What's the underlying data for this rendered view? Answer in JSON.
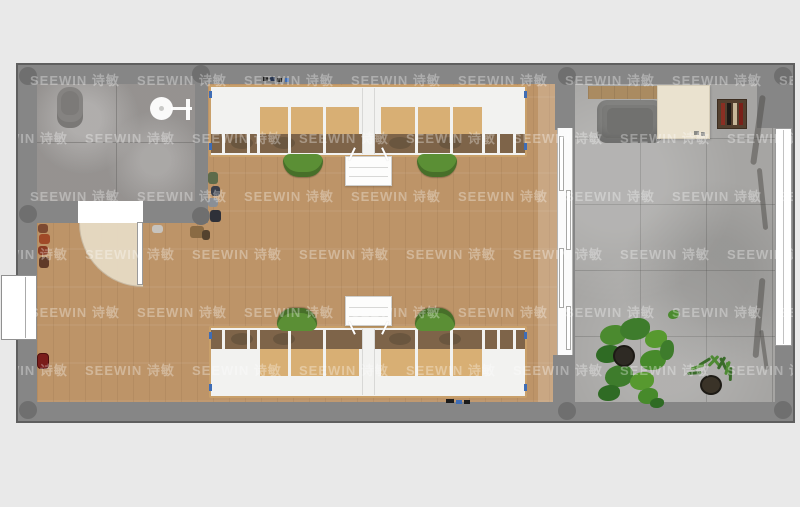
{
  "watermark": {
    "text": "SEEWIN 诗敏"
  },
  "colors": {
    "background": "#e9e9e9",
    "wall": "#868686",
    "wall_outline": "#5f5f5f",
    "column": "#6f6f6f",
    "wood_floor": "#bd9468",
    "bathroom_tile": "#b3b0ae",
    "concrete_floor": "#a6a5a3",
    "desk_frame_wood": "#c9a06a",
    "desktop_wood": "#d8af74",
    "under_desk_shadow": "#7e6449",
    "partition_white": "#f2f2f0",
    "chair_green": "#5b8f35",
    "plant_green": "#3e7c2c",
    "cream_desk": "#eae2cf",
    "credenza_wood": "#aa8b61",
    "lounge_gray": "#7b7b79",
    "shelf_brown": "#54402f",
    "door_arc": "#e8ddc7",
    "accent_blue": "#3f6db5",
    "extinguisher_red": "#7a1d1a",
    "watermark_color": "rgba(255,255,255,0.33)"
  }
}
